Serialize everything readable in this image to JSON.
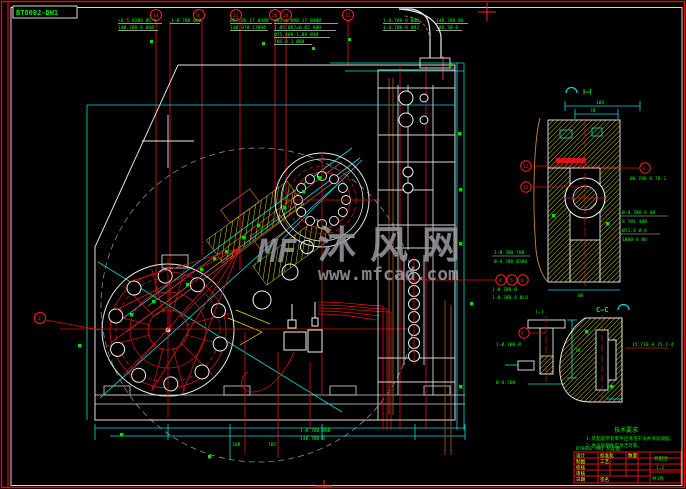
{
  "doc": {
    "code": "BT8002-DW1"
  },
  "watermark": {
    "logo": "MF",
    "title": "沐风网",
    "url": "www.mfcad.com"
  },
  "sections": {
    "bb": "Ⅰ—Ⅰ",
    "aa": "Ⅰ-Ⅰ",
    "cc": "C—C"
  },
  "balloons": {
    "top": [
      "14",
      "8",
      "21",
      "26",
      "28",
      "31"
    ],
    "trio": [
      "4",
      "5",
      "6"
    ],
    "section_left": [
      "12",
      "15"
    ],
    "section_right": [
      "3"
    ],
    "detail": [
      "7"
    ],
    "left": [
      "2"
    ]
  },
  "dims": {
    "a1": "+0.5 Ø2Ø8 Ø5-8",
    "a2": "14Ø.7Ø8-8 Ø8Ø",
    "b1": "1-Ø.7Ø8-Ø8Ø",
    "c1": "Ø87.Ø8-17 Ø4ØØ",
    "c2": "14Ø.87Ø-17Ø8Ø",
    "d1": "Ø81.4 Ø8Ø-17 Ø4ØØ",
    "d2": "1.Ø5 Ø87±Ø.Ø2 8ØØ",
    "d3": "Ø75.4Ø8-1.Ø8 Ø4Ø",
    "d4": "7Ø5-8.1 Ø8Ø",
    "e1": "1-8.7Ø8-8 Ø8Ø",
    "e2": "1-8.7Ø8-8 8Ø2",
    "f1": "14Ø.7Ø8 Ø8",
    "f2": "1Ø8.7Ø-8",
    "r1": "1-Ø.7Ø8 78Ø",
    "r2": "Ø-8.7Ø8 Ø2Ø8",
    "r3": "1-Ø.7Ø8-Ø",
    "r4": "1-Ø.7Ø8-8 ØL8",
    "r5": "1-Ø.7Ø8-Ø",
    "r6": "Ø-8.7Ø8",
    "sr1": "Ø-8.7Ø8-8 8Ø",
    "sr2": "8 7Ø1 4ØØ",
    "sr3": "Ø71.8 Ø-8",
    "sr4": "1Ø8Ø-8 Ø8",
    "sd1": "1Ø4",
    "sd2": "7Ø",
    "sd3": "Ø8",
    "sl": "Ø8.7Ø8-8 78-2",
    "dl": "15.718-8  15-2-4",
    "b2": "14Ø.7Ø8-8",
    "b3": "18Ø",
    "b4": "7Ø1",
    "dd1": "78"
  },
  "notes": {
    "kicker": "技术要求",
    "line1": "1.装配前所有零件应清洗干净并涂润滑脂。",
    "line2": "2.各运动部件应灵活可靠。"
  },
  "title_block": {
    "above": "BT8002-DW1 装配图",
    "row1": "设计",
    "row2": "制图",
    "row3": "校核",
    "row4": "审核",
    "mid1": "标准化",
    "mid2": "工艺",
    "mid3": "数量",
    "name": "装配图",
    "scale": "1:2",
    "sheet": "共1张",
    "bot1": "日期",
    "bot2": "签名"
  }
}
